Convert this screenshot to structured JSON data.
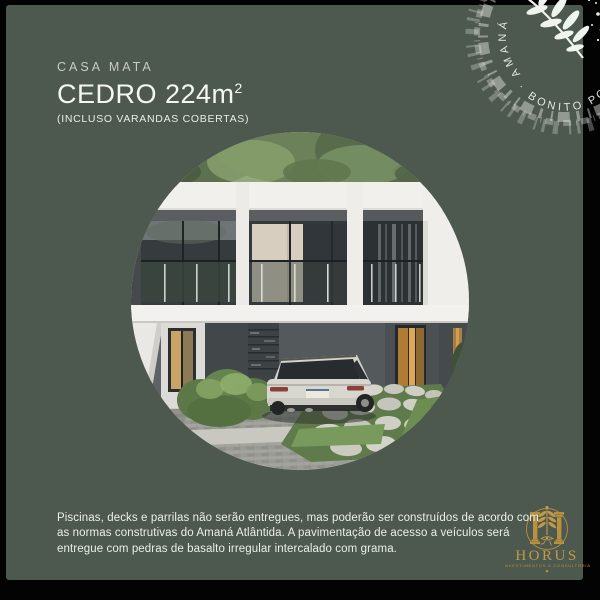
{
  "poster": {
    "background_color": "#030303",
    "card_color": "#4d584e",
    "header": {
      "eyebrow": "CASA MATA",
      "title": "CEDRO 224m",
      "title_superscript": "2",
      "subtitle": "(INCLUSO VARANDAS COBERTAS)"
    },
    "stamp": {
      "brand": "AMANÁ",
      "separator": "·",
      "slogan": "BONITO POR",
      "icon": "olive-branch-icon",
      "text_color": "#e3e8de"
    },
    "photo": {
      "description": "Modern two-story white house with glass facade, silver station wagon parked in front, stone flagstone path, hedges and trees"
    },
    "footer": {
      "disclaimer": "Piscinas, decks e parrilas não serão entregues, mas poderão ser construídos de acordo com as normas construtivas do Amaná Atlântida. A pavimentação de acesso a veículos será entregue com pedras de basalto irregular intercalado com grama."
    },
    "logo": {
      "name": "HORUS",
      "tagline": "INVESTIMENTOS & CONSULTORIA",
      "color": "#bf9a4d"
    }
  }
}
